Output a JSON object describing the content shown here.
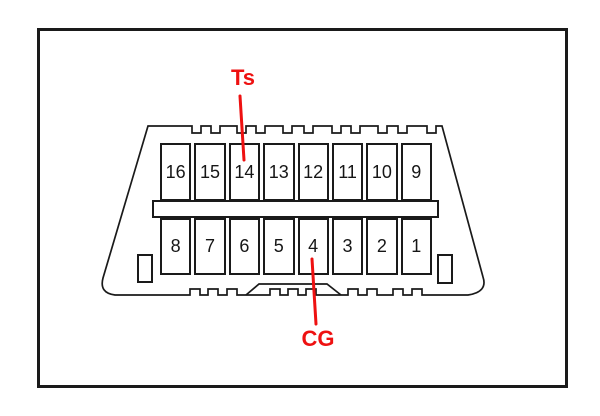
{
  "diagram": {
    "kind": "connector-pinout",
    "pins": {
      "top": [
        "16",
        "15",
        "14",
        "13",
        "12",
        "11",
        "10",
        "9"
      ],
      "bottom": [
        "8",
        "7",
        "6",
        "5",
        "4",
        "3",
        "2",
        "1"
      ]
    },
    "annotations": {
      "ts": {
        "label": "Ts",
        "target_pin": "14",
        "position": "top"
      },
      "cg": {
        "label": "CG",
        "target_pin": "4",
        "position": "bottom"
      }
    }
  },
  "colors": {
    "annotation_red": "#ee1111",
    "outline_black": "#1a1a1a",
    "background": "#ffffff"
  }
}
